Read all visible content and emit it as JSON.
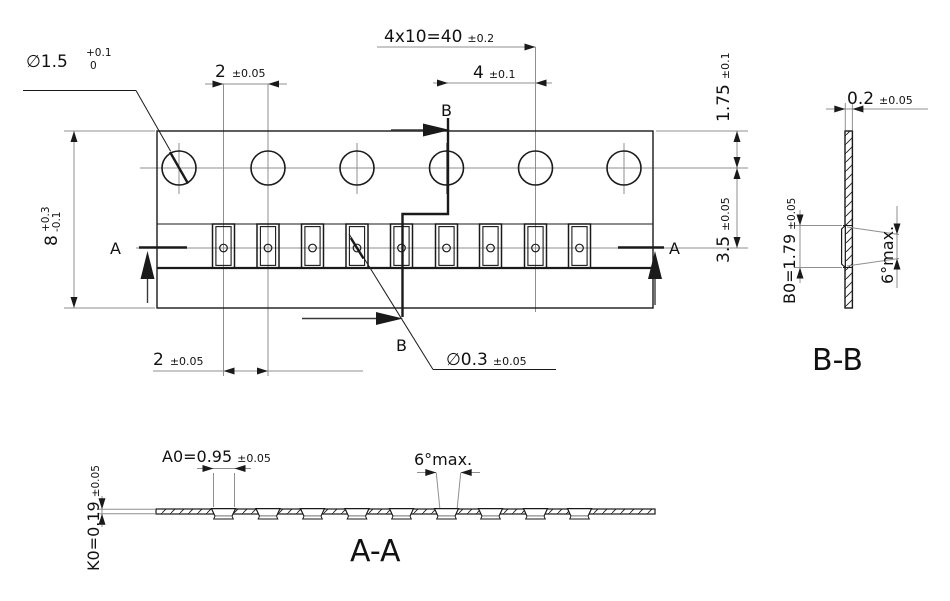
{
  "drawing": {
    "background": "#ffffff",
    "line_color": "#1a1a1a",
    "centerline_color": "#8f8f8f",
    "top_view": {
      "sprocket_hole_count": 6,
      "pocket_count": 9,
      "dim_pitch_total": {
        "value": "4x10=40",
        "tol": "±0.2"
      },
      "dim_hole_pitch": {
        "value": "4",
        "tol": "±0.1"
      },
      "dim_pocket_offset_top": {
        "value": "2",
        "tol": "±0.05"
      },
      "dim_pocket_pitch_bottom": {
        "value": "2",
        "tol": "±0.05"
      },
      "dim_sprocket_hole_dia": {
        "value": "∅1.5",
        "tol_upper": "+0.1",
        "tol_lower": "0"
      },
      "dim_tape_width": {
        "value": "8",
        "tol_upper": "+0.3",
        "tol_lower": "-0.1"
      },
      "dim_edge_to_hole_center": {
        "value": "1.75",
        "tol": "±0.1"
      },
      "dim_hole_to_pocket_center": {
        "value": "3.5",
        "tol": "±0.05"
      },
      "dim_pocket_hole_dia": {
        "value": "∅0.3",
        "tol": "±0.05"
      },
      "section_b_label_top": "B",
      "section_b_label_bottom": "B",
      "section_a_label_left": "A",
      "section_a_label_right": "A"
    },
    "section_bb": {
      "title": "B-B",
      "dim_thickness": {
        "value": "0.2",
        "tol": "±0.05"
      },
      "dim_pocket_width": {
        "value": "B0=1.79",
        "tol": "±0.05"
      },
      "dim_taper": {
        "value": "6°max."
      }
    },
    "section_aa": {
      "title": "A-A",
      "dim_pocket_length": {
        "value": "A0=0.95",
        "tol": "±0.05"
      },
      "dim_taper": {
        "value": "6°max."
      },
      "dim_pocket_depth": {
        "value": "K0=0.19",
        "tol": "±0.05"
      }
    }
  }
}
